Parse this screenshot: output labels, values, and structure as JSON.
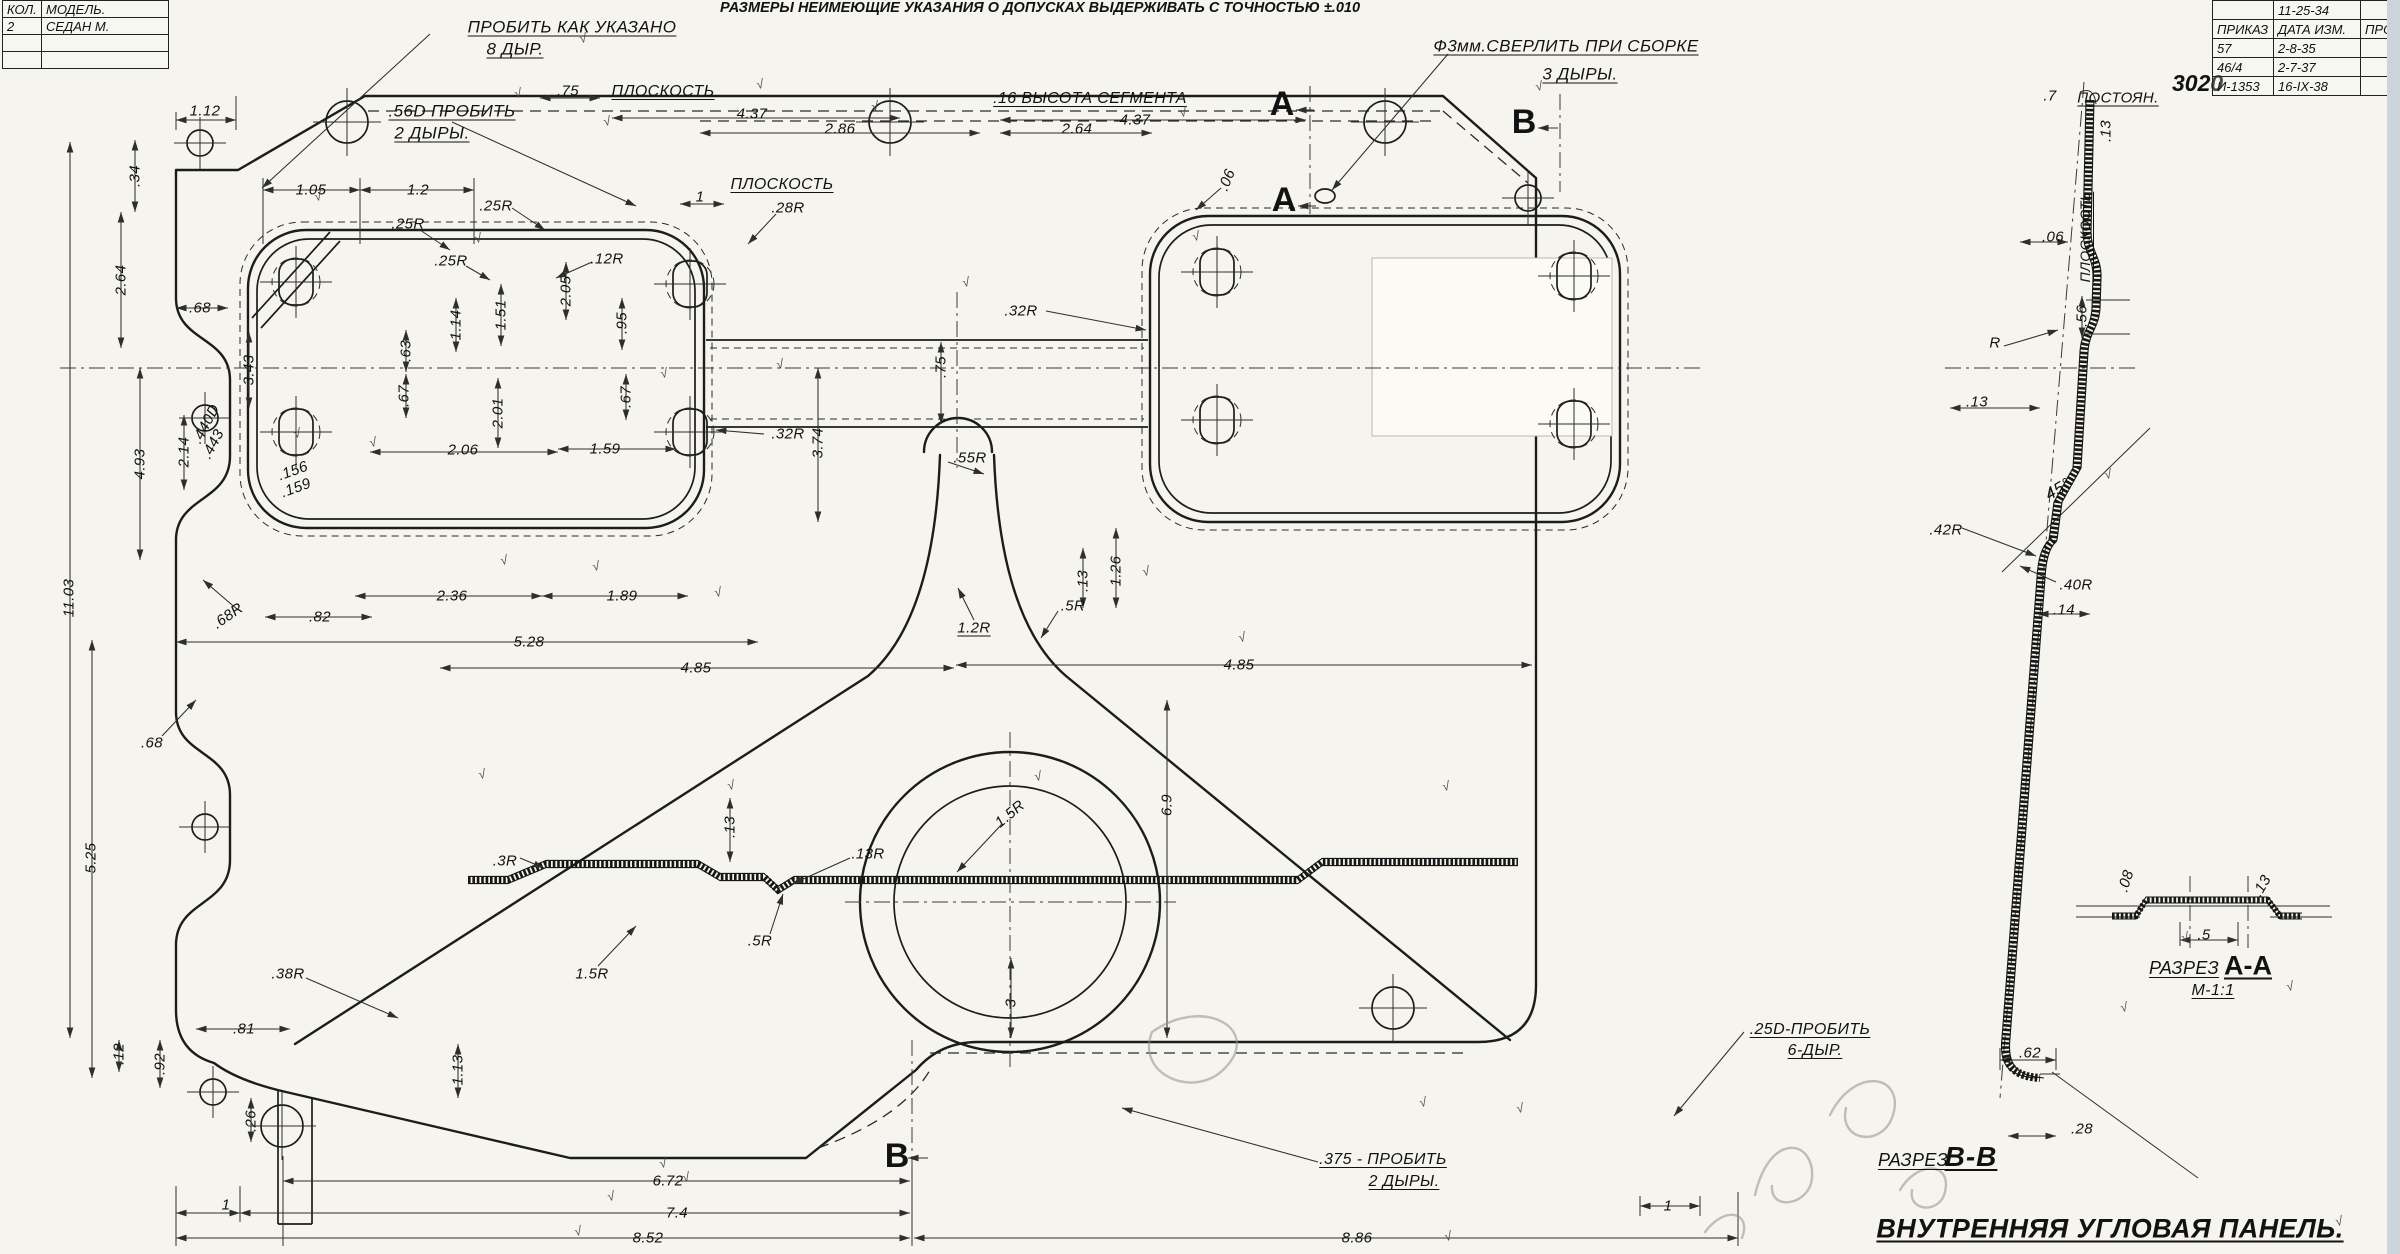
{
  "colors": {
    "paper": "#f5f4ee",
    "ink": "#1c1c1c",
    "pencil": "#8f8f8f",
    "scan_edge": "#ccd4dc"
  },
  "tolerance_note": "РАЗМЕРЫ НЕИМЕЮЩИЕ УКАЗАНИЯ О ДОПУСКАХ ВЫДЕРЖИВАТЬ С ТОЧНОСТЬЮ ±.010",
  "title": "ВНУТРЕННЯЯ УГЛОВАЯ ПАНЕЛЬ.",
  "stamp": "3020",
  "check_glyph": "√",
  "tables": {
    "model": {
      "x": 2,
      "y": 0,
      "col_widths": [
        34,
        122
      ],
      "row_height": 16,
      "rows": [
        [
          "КОЛ.",
          "МОДЕЛЬ."
        ],
        [
          "2",
          "СЕДАН М."
        ],
        [
          "",
          ""
        ],
        [
          "",
          ""
        ]
      ]
    },
    "revision": {
      "x": 2212,
      "y": 0,
      "col_widths": [
        56,
        82,
        36
      ],
      "row_height": 18,
      "rows": [
        [
          "",
          "11-25-34",
          ""
        ],
        [
          "ПРИКАЗ",
          "ДАТА ИЗМ.",
          "ПРОВ."
        ],
        [
          "57",
          "2-8-35",
          ""
        ],
        [
          "46/4",
          "2-7-37",
          ""
        ],
        [
          "И-1353",
          "16-IX-38",
          ""
        ]
      ]
    }
  },
  "labels": [
    {
      "t": "ПРОБИТЬ КАК УКАЗАНО",
      "x": 572,
      "y": 27,
      "u": 1,
      "s": 17
    },
    {
      "t": "8 ДЫР.",
      "x": 515,
      "y": 49,
      "u": 1,
      "s": 17
    },
    {
      "t": ".56D ПРОБИТЬ",
      "x": 452,
      "y": 111,
      "u": 1,
      "s": 17
    },
    {
      "t": "2 ДЫРЫ.",
      "x": 432,
      "y": 133,
      "u": 1,
      "s": 17
    },
    {
      "t": ".75",
      "x": 568,
      "y": 91
    },
    {
      "t": "ПЛОСКОСТЬ",
      "x": 663,
      "y": 92,
      "u": 1,
      "s": 16
    },
    {
      "t": "4.37",
      "x": 752,
      "y": 114
    },
    {
      "t": "2.86",
      "x": 840,
      "y": 129
    },
    {
      "t": "2.64",
      "x": 1077,
      "y": 129
    },
    {
      "t": "4.37",
      "x": 1135,
      "y": 120
    },
    {
      "t": ".16 ВЫСОТА СЕГМЕНТА",
      "x": 1090,
      "y": 99,
      "u": 1,
      "s": 16
    },
    {
      "t": "Ф3мм.СВЕРЛИТЬ ПРИ СБОРКЕ",
      "x": 1566,
      "y": 46,
      "u": 1,
      "s": 17
    },
    {
      "t": "3 ДЫРЫ.",
      "x": 1580,
      "y": 74,
      "u": 1,
      "s": 17
    },
    {
      "t": "A",
      "x": 1282,
      "y": 104,
      "s": 34,
      "w": 1,
      "cls": "marker"
    },
    {
      "t": "A",
      "x": 1284,
      "y": 200,
      "s": 34,
      "w": 1,
      "cls": "marker"
    },
    {
      "t": "B",
      "x": 1524,
      "y": 122,
      "s": 34,
      "w": 1,
      "cls": "marker"
    },
    {
      "t": ".7",
      "x": 2050,
      "y": 96
    },
    {
      "t": "ПОСТОЯН.",
      "x": 2118,
      "y": 98,
      "u": 1
    },
    {
      "t": ".13",
      "x": 2106,
      "y": 131,
      "r": -90
    },
    {
      "t": "1.12",
      "x": 205,
      "y": 111
    },
    {
      "t": ".34",
      "x": 135,
      "y": 176,
      "r": -90
    },
    {
      "t": "2.64",
      "x": 121,
      "y": 280,
      "r": -90
    },
    {
      "t": ".68",
      "x": 200,
      "y": 308
    },
    {
      "t": "3.43",
      "x": 249,
      "y": 370,
      "r": -90
    },
    {
      "t": ".440D",
      "x": 206,
      "y": 424,
      "r": -62
    },
    {
      "t": ".443",
      "x": 213,
      "y": 444,
      "r": -62
    },
    {
      "t": "2.14",
      "x": 184,
      "y": 452,
      "r": -90
    },
    {
      "t": "4.93",
      "x": 140,
      "y": 464,
      "r": -90
    },
    {
      "t": "11.03",
      "x": 69,
      "y": 598,
      "r": -90
    },
    {
      "t": ".68R",
      "x": 228,
      "y": 616,
      "r": -35
    },
    {
      "t": ".68",
      "x": 152,
      "y": 743
    },
    {
      "t": "5.25",
      "x": 91,
      "y": 858,
      "r": -90
    },
    {
      "t": "1.05",
      "x": 311,
      "y": 190
    },
    {
      "t": "1.2",
      "x": 418,
      "y": 190
    },
    {
      "t": ".25R",
      "x": 496,
      "y": 206
    },
    {
      "t": ".25R",
      "x": 408,
      "y": 224
    },
    {
      "t": ".25R",
      "x": 451,
      "y": 261
    },
    {
      "t": ".12R",
      "x": 607,
      "y": 259
    },
    {
      "t": "2.05",
      "x": 566,
      "y": 291,
      "r": -90
    },
    {
      "t": "1.14",
      "x": 456,
      "y": 325,
      "r": -90
    },
    {
      "t": "1.51",
      "x": 501,
      "y": 315,
      "r": -90
    },
    {
      "t": ".95",
      "x": 622,
      "y": 323,
      "r": -90
    },
    {
      "t": ".63",
      "x": 406,
      "y": 351,
      "r": -90
    },
    {
      "t": ".67",
      "x": 404,
      "y": 396,
      "r": -90
    },
    {
      "t": ".67",
      "x": 626,
      "y": 397,
      "r": -90
    },
    {
      "t": "2.01",
      "x": 498,
      "y": 413,
      "r": -90
    },
    {
      "t": "2.06",
      "x": 463,
      "y": 450
    },
    {
      "t": "1.59",
      "x": 605,
      "y": 449
    },
    {
      "t": ".156",
      "x": 293,
      "y": 471,
      "r": -20
    },
    {
      "t": ".159",
      "x": 296,
      "y": 488,
      "r": -20
    },
    {
      "t": "2.36",
      "x": 452,
      "y": 596
    },
    {
      "t": "1.89",
      "x": 622,
      "y": 596
    },
    {
      "t": ".82",
      "x": 320,
      "y": 617
    },
    {
      "t": "5.28",
      "x": 529,
      "y": 642
    },
    {
      "t": "4.85",
      "x": 696,
      "y": 668
    },
    {
      "t": "4.85",
      "x": 1239,
      "y": 665
    },
    {
      "t": "ПЛОСКОСТЬ",
      "x": 782,
      "y": 185,
      "u": 1,
      "s": 16
    },
    {
      "t": "1",
      "x": 700,
      "y": 197
    },
    {
      "t": ".28R",
      "x": 788,
      "y": 208
    },
    {
      "t": ".06",
      "x": 1227,
      "y": 180,
      "r": -68
    },
    {
      "t": ".32R",
      "x": 1021,
      "y": 311
    },
    {
      "t": ".75",
      "x": 941,
      "y": 367,
      "r": -90
    },
    {
      "t": ".32R",
      "x": 788,
      "y": 434
    },
    {
      "t": "3.74",
      "x": 818,
      "y": 443,
      "r": -90
    },
    {
      "t": ".55R",
      "x": 970,
      "y": 458
    },
    {
      "t": "1.2R",
      "x": 974,
      "y": 628,
      "u": 1
    },
    {
      "t": ".5R",
      "x": 1073,
      "y": 606
    },
    {
      "t": ".13",
      "x": 1083,
      "y": 581,
      "r": -90
    },
    {
      "t": "1.26",
      "x": 1116,
      "y": 571,
      "r": -90
    },
    {
      "t": ".3R",
      "x": 505,
      "y": 861
    },
    {
      "t": ".13",
      "x": 730,
      "y": 827,
      "r": -90
    },
    {
      "t": ".13R",
      "x": 868,
      "y": 854
    },
    {
      "t": "1.5R",
      "x": 1010,
      "y": 814,
      "r": -40
    },
    {
      "t": "6.9",
      "x": 1167,
      "y": 805,
      "r": -90
    },
    {
      "t": ".5R",
      "x": 760,
      "y": 941
    },
    {
      "t": "1.5R",
      "x": 592,
      "y": 974
    },
    {
      "t": "3",
      "x": 1011,
      "y": 1003,
      "r": -90
    },
    {
      "t": ".38R",
      "x": 288,
      "y": 974
    },
    {
      "t": ".81",
      "x": 244,
      "y": 1029
    },
    {
      "t": ".12",
      "x": 119,
      "y": 1054,
      "r": -90
    },
    {
      "t": ".92",
      "x": 160,
      "y": 1064,
      "r": -90
    },
    {
      "t": ".26",
      "x": 251,
      "y": 1121,
      "r": -90
    },
    {
      "t": "1.13",
      "x": 458,
      "y": 1070,
      "r": -90
    },
    {
      "t": "B",
      "x": 897,
      "y": 1156,
      "s": 34,
      "w": 1,
      "cls": "marker"
    },
    {
      "t": "1",
      "x": 226,
      "y": 1205
    },
    {
      "t": "6.72",
      "x": 668,
      "y": 1181
    },
    {
      "t": "7.4",
      "x": 677,
      "y": 1213
    },
    {
      "t": "8.52",
      "x": 648,
      "y": 1238
    },
    {
      "t": "8.86",
      "x": 1357,
      "y": 1238
    },
    {
      "t": "1",
      "x": 1668,
      "y": 1206
    },
    {
      "t": ".375 - ПРОБИТЬ",
      "x": 1383,
      "y": 1160,
      "u": 1,
      "s": 16
    },
    {
      "t": "2 ДЫРЫ.",
      "x": 1404,
      "y": 1182,
      "u": 1,
      "s": 16
    },
    {
      "t": ".25D-ПРОБИТЬ",
      "x": 1810,
      "y": 1030,
      "u": 1,
      "s": 16
    },
    {
      "t": "6-ДЫР.",
      "x": 1815,
      "y": 1051,
      "u": 1,
      "s": 16
    },
    {
      "t": ".06",
      "x": 2053,
      "y": 237
    },
    {
      "t": "ПЛОСКОСТЬ",
      "x": 2085,
      "y": 237,
      "r": -90,
      "u": 1,
      "s": 14
    },
    {
      "t": ".56",
      "x": 2082,
      "y": 316,
      "r": -90
    },
    {
      "t": "R",
      "x": 1995,
      "y": 343
    },
    {
      "t": ".13",
      "x": 1977,
      "y": 402
    },
    {
      "t": "45°",
      "x": 2058,
      "y": 489,
      "r": -30,
      "s": 17
    },
    {
      "t": ".42R",
      "x": 1946,
      "y": 530
    },
    {
      "t": ".40R",
      "x": 2076,
      "y": 585
    },
    {
      "t": ".14",
      "x": 2064,
      "y": 610
    },
    {
      "t": ".08",
      "x": 2126,
      "y": 881,
      "r": -72
    },
    {
      "t": ".13",
      "x": 2262,
      "y": 886,
      "r": -60
    },
    {
      "t": ".5",
      "x": 2204,
      "y": 935
    },
    {
      "t": "РАЗРЕЗ",
      "x": 2184,
      "y": 968,
      "s": 18,
      "u": 1
    },
    {
      "t": "А-А",
      "x": 2248,
      "y": 966,
      "s": 27,
      "w": 1,
      "u": 1,
      "cls": "marker"
    },
    {
      "t": "М-1:1",
      "x": 2213,
      "y": 991,
      "s": 16,
      "u": 1
    },
    {
      "t": ".62",
      "x": 2030,
      "y": 1053
    },
    {
      "t": ".28",
      "x": 2082,
      "y": 1129
    },
    {
      "t": "РАЗРЕЗ",
      "x": 1913,
      "y": 1160,
      "s": 18,
      "u": 1
    },
    {
      "t": "В-В",
      "x": 1971,
      "y": 1157,
      "s": 28,
      "w": 1,
      "u": 1,
      "cls": "hand"
    }
  ],
  "checks": [
    [
      583,
      38
    ],
    [
      760,
      84
    ],
    [
      607,
      121
    ],
    [
      318,
      196
    ],
    [
      478,
      238
    ],
    [
      966,
      282
    ],
    [
      1196,
      236
    ],
    [
      780,
      364
    ],
    [
      373,
      442
    ],
    [
      504,
      560
    ],
    [
      596,
      566
    ],
    [
      718,
      592
    ],
    [
      1242,
      637
    ],
    [
      731,
      785
    ],
    [
      1446,
      786
    ],
    [
      482,
      774
    ],
    [
      1038,
      776
    ],
    [
      663,
      1163
    ],
    [
      611,
      1196
    ],
    [
      578,
      1231
    ],
    [
      1423,
      1102
    ],
    [
      1448,
      1236
    ],
    [
      2124,
      1007
    ],
    [
      2185,
      937
    ],
    [
      2290,
      986
    ],
    [
      1539,
      86
    ],
    [
      1183,
      112
    ],
    [
      875,
      106
    ],
    [
      2339,
      1221
    ],
    [
      518,
      93
    ],
    [
      664,
      373
    ],
    [
      1146,
      571
    ],
    [
      297,
      433
    ],
    [
      2108,
      474
    ],
    [
      686,
      1177
    ],
    [
      1520,
      1108
    ]
  ]
}
